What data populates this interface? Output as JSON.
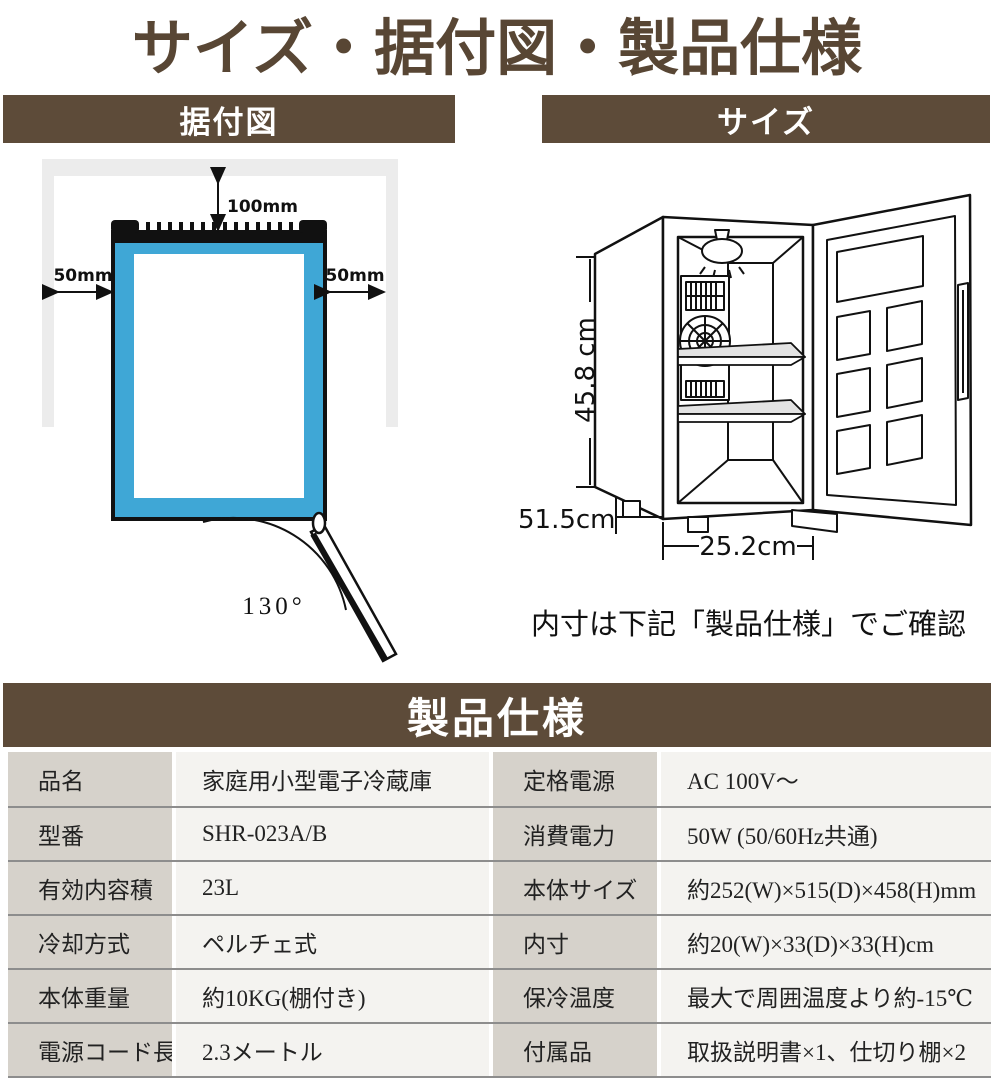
{
  "title": "サイズ・据付図・製品仕様",
  "sections": {
    "install": "据付図",
    "size": "サイズ",
    "spec": "製品仕様"
  },
  "install_diagram": {
    "top_clearance": "100mm",
    "left_clearance": "50mm",
    "right_clearance": "50mm",
    "door_angle": "130°"
  },
  "size_diagram": {
    "height": "45.8 cm",
    "depth": "51.5cm",
    "width": "25.2cm",
    "note": "内寸は下記「製品仕様」でご確認"
  },
  "spec_table": {
    "rows": [
      {
        "l1": "品名",
        "v1": "家庭用小型電子冷蔵庫",
        "l2": "定格電源",
        "v2": "AC 100V～"
      },
      {
        "l1": "型番",
        "v1": "SHR-023A/B",
        "l2": "消費電力",
        "v2": "50W (50/60Hz共通)"
      },
      {
        "l1": "有効内容積",
        "v1": "23L",
        "l2": "本体サイズ",
        "v2": "約252(W)×515(D)×458(H)mm"
      },
      {
        "l1": "冷却方式",
        "v1": "ペルチェ式",
        "l2": "内寸",
        "v2": "約20(W)×33(D)×33(H)cm"
      },
      {
        "l1": "本体重量",
        "v1": "約10KG(棚付き)",
        "l2": "保冷温度",
        "v2": "最大で周囲温度より約-15℃"
      },
      {
        "l1": "電源コード長",
        "v1": "2.3メートル",
        "l2": "付属品",
        "v2": "取扱説明書×1、仕切り棚×2"
      }
    ]
  },
  "colors": {
    "brown": "#5d4b39",
    "title_brown": "#584634",
    "blue": "#3fa7d6",
    "wall_gray": "#ececec",
    "label_bg": "#d6d2cb",
    "value_bg": "#f4f3f0"
  }
}
